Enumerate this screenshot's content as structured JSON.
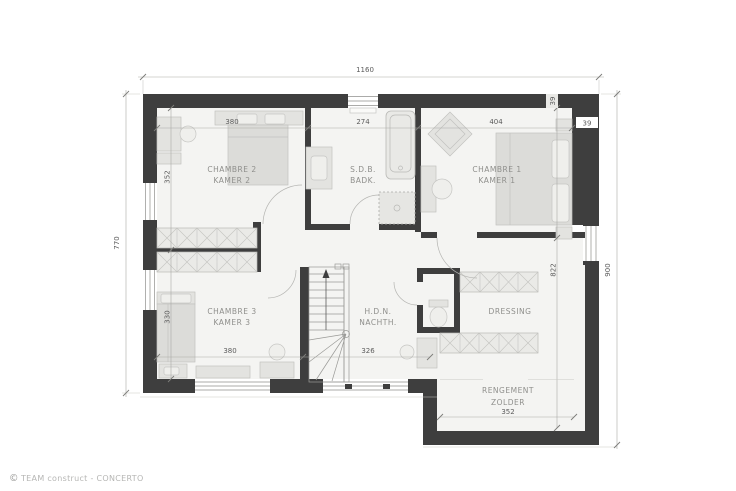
{
  "rooms": {
    "chambre2": {
      "name_fr": "CHAMBRE 2",
      "name_nl": "KAMER 2"
    },
    "sdb": {
      "name_fr": "S.D.B.",
      "name_nl": "BADK."
    },
    "chambre1": {
      "name_fr": "CHAMBRE 1",
      "name_nl": "KAMER 1"
    },
    "chambre3": {
      "name_fr": "CHAMBRE 3",
      "name_nl": "KAMER 3"
    },
    "hdn": {
      "name_fr": "H.D.N.",
      "name_nl": "NACHTH."
    },
    "dressing": {
      "name_fr": "DRESSING"
    },
    "rangement": {
      "name_fr": "RENGEMENT",
      "name_nl": "ZOLDER"
    }
  },
  "dims": {
    "top_total": "1160",
    "left_total": "770",
    "right_total": "900",
    "chambre2_width": "380",
    "sdb_width": "274",
    "chambre1_width": "404",
    "wall_thickness_top": "39",
    "wall_thickness_right": "39",
    "chambre2_depth": "352",
    "chambre3_depth": "330",
    "chambre3_width": "380",
    "hdn_width": "326",
    "dressing_depth": "822",
    "rangement_width": "352"
  },
  "footer": {
    "logo_glyph": "©",
    "brand": "TEAM construct - CONCERTO"
  },
  "colors": {
    "wall": "#3e3e3e",
    "floor": "#f4f4f2",
    "background": "#ffffff"
  }
}
